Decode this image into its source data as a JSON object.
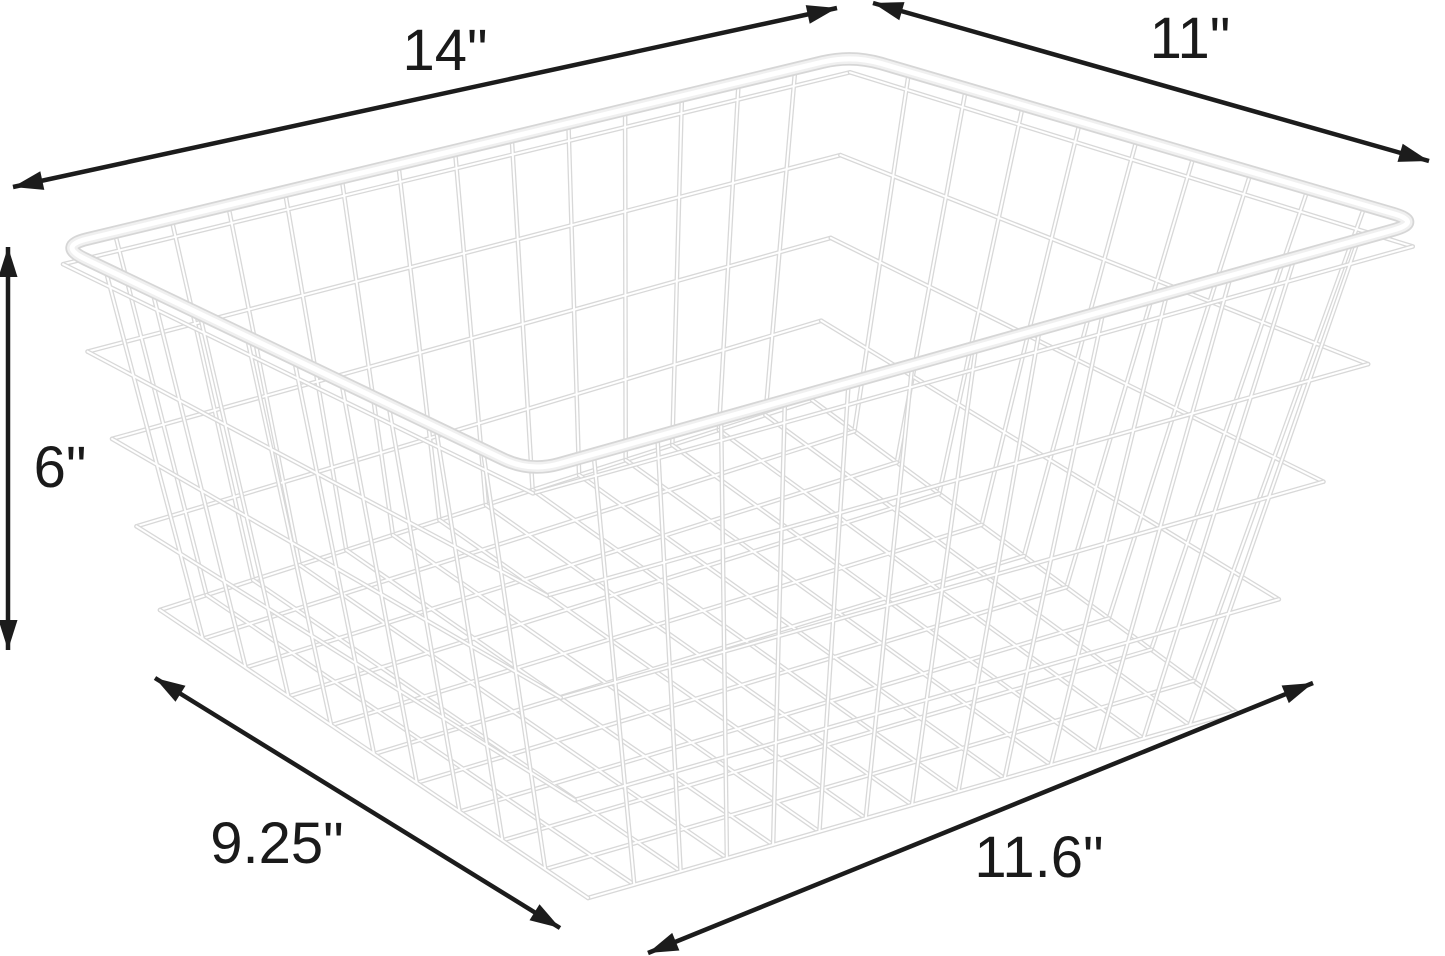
{
  "figure": {
    "subject": "white wire storage basket dimension diagram",
    "background": "#ffffff"
  },
  "dimension_labels": {
    "top_width": "14\"",
    "top_depth": "11\"",
    "height": "6\"",
    "bottom_depth": "9.25\"",
    "bottom_width": "11.6\""
  },
  "colors": {
    "background": "#ffffff",
    "annotation": "#1c1c1c",
    "wire_outline": "#d8d8d8",
    "wire_fill": "#ffffff",
    "rim_outline": "#d6d6d6",
    "rim_fill": "#f0f0f0",
    "rim_highlight": "#ffffff"
  }
}
